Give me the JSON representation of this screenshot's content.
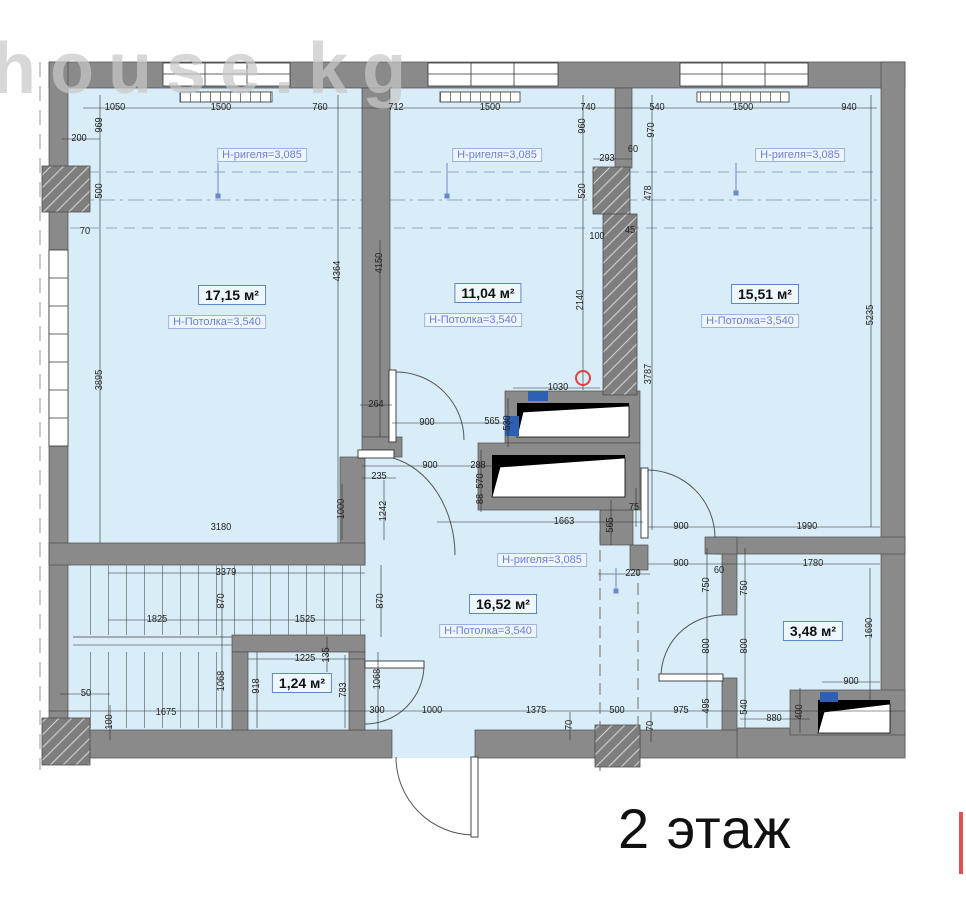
{
  "title": "2 этаж",
  "watermark": "house.kg",
  "colors": {
    "room_fill": "#d9edf8",
    "wall_gray": "#8a8a8a",
    "dim_text": "#222222",
    "label_blue": "#6b7fd0",
    "accent_red": "#e04040",
    "marker_blue": "#2f5fb3"
  },
  "labels": {
    "beam_text": "Н-ригеля=3,085",
    "ceiling_text": "Н-Потолка=3,540"
  },
  "rooms": [
    {
      "area": "17,15 м²",
      "has_ceiling": true,
      "x": 232,
      "y": 295
    },
    {
      "area": "11,04 м²",
      "has_ceiling": true,
      "x": 488,
      "y": 293
    },
    {
      "area": "15,51 м²",
      "has_ceiling": true,
      "x": 765,
      "y": 294
    },
    {
      "area": "16,52 м²",
      "has_ceiling": true,
      "x": 503,
      "y": 604
    },
    {
      "area": "1,24 м²",
      "has_ceiling": false,
      "x": 302,
      "y": 683
    },
    {
      "area": "3,48 м²",
      "has_ceiling": false,
      "x": 813,
      "y": 631
    }
  ],
  "beam_labels": [
    {
      "x": 262,
      "y": 155
    },
    {
      "x": 497,
      "y": 155
    },
    {
      "x": 800,
      "y": 155
    },
    {
      "x": 542,
      "y": 560
    }
  ],
  "dimensions": [
    {
      "t": "1050",
      "x": 115,
      "y": 108
    },
    {
      "t": "1500",
      "x": 221,
      "y": 108
    },
    {
      "t": "760",
      "x": 320,
      "y": 108
    },
    {
      "t": "712",
      "x": 396,
      "y": 108
    },
    {
      "t": "1500",
      "x": 490,
      "y": 108
    },
    {
      "t": "740",
      "x": 588,
      "y": 108
    },
    {
      "t": "540",
      "x": 657,
      "y": 108
    },
    {
      "t": "1500",
      "x": 743,
      "y": 108
    },
    {
      "t": "940",
      "x": 849,
      "y": 108
    },
    {
      "t": "969",
      "x": 100,
      "y": 125,
      "v": 1
    },
    {
      "t": "200",
      "x": 79,
      "y": 139
    },
    {
      "t": "500",
      "x": 100,
      "y": 191,
      "v": 1
    },
    {
      "t": "70",
      "x": 85,
      "y": 232
    },
    {
      "t": "960",
      "x": 583,
      "y": 126,
      "v": 1
    },
    {
      "t": "970",
      "x": 652,
      "y": 130,
      "v": 1
    },
    {
      "t": "293",
      "x": 607,
      "y": 159
    },
    {
      "t": "60",
      "x": 633,
      "y": 150
    },
    {
      "t": "520",
      "x": 583,
      "y": 191,
      "v": 1
    },
    {
      "t": "478",
      "x": 649,
      "y": 193,
      "v": 1
    },
    {
      "t": "100",
      "x": 597,
      "y": 237
    },
    {
      "t": "45",
      "x": 630,
      "y": 231
    },
    {
      "t": "2140",
      "x": 581,
      "y": 300,
      "v": 1
    },
    {
      "t": "3787",
      "x": 649,
      "y": 374,
      "v": 1
    },
    {
      "t": "5235",
      "x": 871,
      "y": 315,
      "v": 1
    },
    {
      "t": "3895",
      "x": 100,
      "y": 380,
      "v": 1
    },
    {
      "t": "4364",
      "x": 338,
      "y": 271,
      "v": 1
    },
    {
      "t": "4150",
      "x": 380,
      "y": 263,
      "v": 1
    },
    {
      "t": "264",
      "x": 376,
      "y": 405
    },
    {
      "t": "900",
      "x": 427,
      "y": 423
    },
    {
      "t": "565",
      "x": 492,
      "y": 422
    },
    {
      "t": "530",
      "x": 508,
      "y": 423,
      "v": 1
    },
    {
      "t": "1030",
      "x": 558,
      "y": 388
    },
    {
      "t": "900",
      "x": 430,
      "y": 466
    },
    {
      "t": "288",
      "x": 478,
      "y": 466
    },
    {
      "t": "570",
      "x": 481,
      "y": 481,
      "v": 1
    },
    {
      "t": "88",
      "x": 481,
      "y": 499,
      "v": 1
    },
    {
      "t": "235",
      "x": 379,
      "y": 477
    },
    {
      "t": "1242",
      "x": 384,
      "y": 511,
      "v": 1
    },
    {
      "t": "1000",
      "x": 342,
      "y": 509,
      "v": 1
    },
    {
      "t": "1663",
      "x": 564,
      "y": 522
    },
    {
      "t": "565",
      "x": 611,
      "y": 525,
      "v": 1
    },
    {
      "t": "75",
      "x": 634,
      "y": 508
    },
    {
      "t": "900",
      "x": 681,
      "y": 527
    },
    {
      "t": "1990",
      "x": 807,
      "y": 527
    },
    {
      "t": "900",
      "x": 681,
      "y": 564
    },
    {
      "t": "1780",
      "x": 813,
      "y": 564
    },
    {
      "t": "220",
      "x": 633,
      "y": 574
    },
    {
      "t": "750",
      "x": 707,
      "y": 585,
      "v": 1
    },
    {
      "t": "60",
      "x": 719,
      "y": 571
    },
    {
      "t": "750",
      "x": 745,
      "y": 588,
      "v": 1
    },
    {
      "t": "800",
      "x": 707,
      "y": 646,
      "v": 1
    },
    {
      "t": "800",
      "x": 745,
      "y": 646,
      "v": 1
    },
    {
      "t": "1690",
      "x": 870,
      "y": 628,
      "v": 1
    },
    {
      "t": "900",
      "x": 851,
      "y": 682
    },
    {
      "t": "495",
      "x": 707,
      "y": 706,
      "v": 1
    },
    {
      "t": "975",
      "x": 681,
      "y": 711
    },
    {
      "t": "540",
      "x": 745,
      "y": 707,
      "v": 1
    },
    {
      "t": "400",
      "x": 800,
      "y": 712,
      "v": 1
    },
    {
      "t": "880",
      "x": 774,
      "y": 719
    },
    {
      "t": "3180",
      "x": 221,
      "y": 528
    },
    {
      "t": "3379",
      "x": 226,
      "y": 573
    },
    {
      "t": "870",
      "x": 222,
      "y": 601,
      "v": 1
    },
    {
      "t": "870",
      "x": 381,
      "y": 601,
      "v": 1
    },
    {
      "t": "1825",
      "x": 157,
      "y": 620
    },
    {
      "t": "1525",
      "x": 305,
      "y": 620
    },
    {
      "t": "1068",
      "x": 222,
      "y": 681,
      "v": 1
    },
    {
      "t": "1068",
      "x": 378,
      "y": 679,
      "v": 1
    },
    {
      "t": "918",
      "x": 257,
      "y": 686,
      "v": 1
    },
    {
      "t": "1225",
      "x": 305,
      "y": 659
    },
    {
      "t": "135",
      "x": 327,
      "y": 655,
      "v": 1
    },
    {
      "t": "783",
      "x": 344,
      "y": 690,
      "v": 1
    },
    {
      "t": "1675",
      "x": 166,
      "y": 713
    },
    {
      "t": "50",
      "x": 86,
      "y": 694
    },
    {
      "t": "100",
      "x": 110,
      "y": 722,
      "v": 1
    },
    {
      "t": "300",
      "x": 377,
      "y": 711
    },
    {
      "t": "1000",
      "x": 432,
      "y": 711
    },
    {
      "t": "1375",
      "x": 536,
      "y": 711
    },
    {
      "t": "500",
      "x": 617,
      "y": 711
    },
    {
      "t": "70",
      "x": 570,
      "y": 725,
      "v": 1
    },
    {
      "t": "70",
      "x": 651,
      "y": 726,
      "v": 1
    }
  ]
}
